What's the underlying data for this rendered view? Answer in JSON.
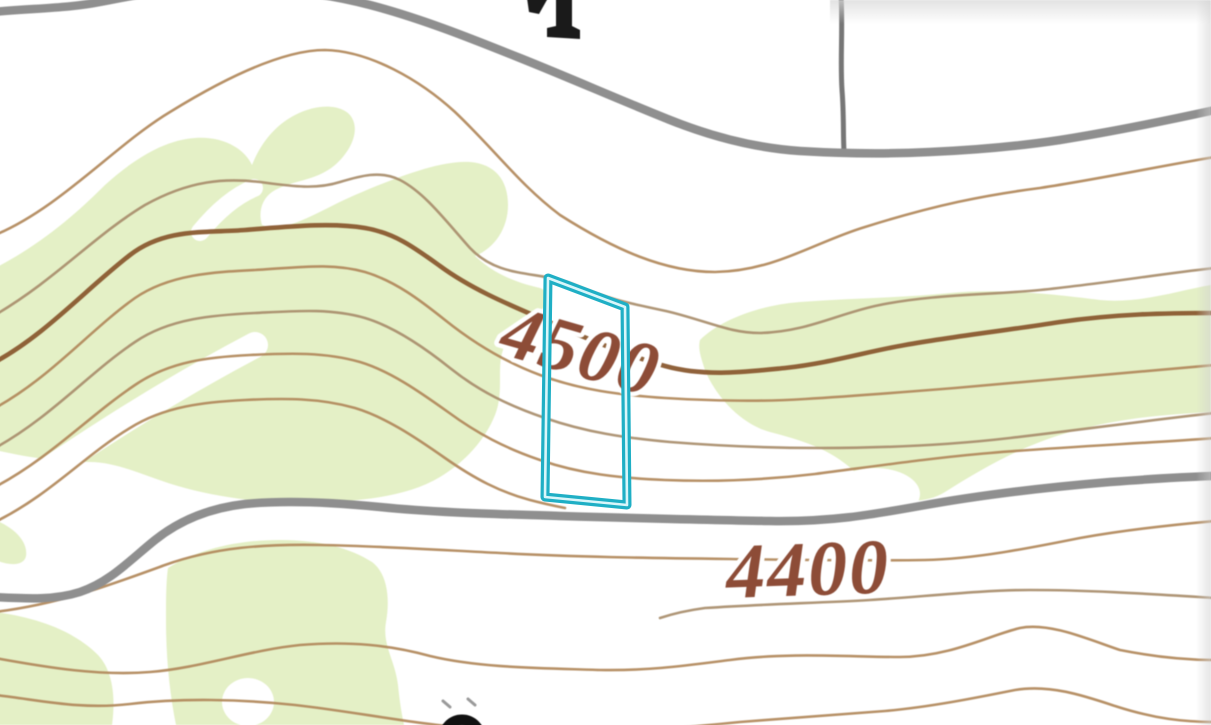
{
  "map": {
    "kind": "topographic-map",
    "elevation_labels": [
      {
        "text": "4500",
        "transform": "translate(497,353) rotate(16)",
        "font_size": "76"
      },
      {
        "text": "4400",
        "transform": "translate(727,598) rotate(-2)",
        "font_size": "78"
      }
    ],
    "parcel": {
      "points": "548,278 625,307 627,505 545,497"
    },
    "colors": {
      "background": "#ffffff",
      "vegetation": "#e4f0c6",
      "contour": "#b1885a",
      "contour_index": "#8a5a30",
      "road": "#8f8f8f",
      "road_secondary": "#767676",
      "label": "#8d4c37",
      "parcel_outline": "#1fafc5",
      "parcel_inner": "#d9f6fa"
    }
  }
}
